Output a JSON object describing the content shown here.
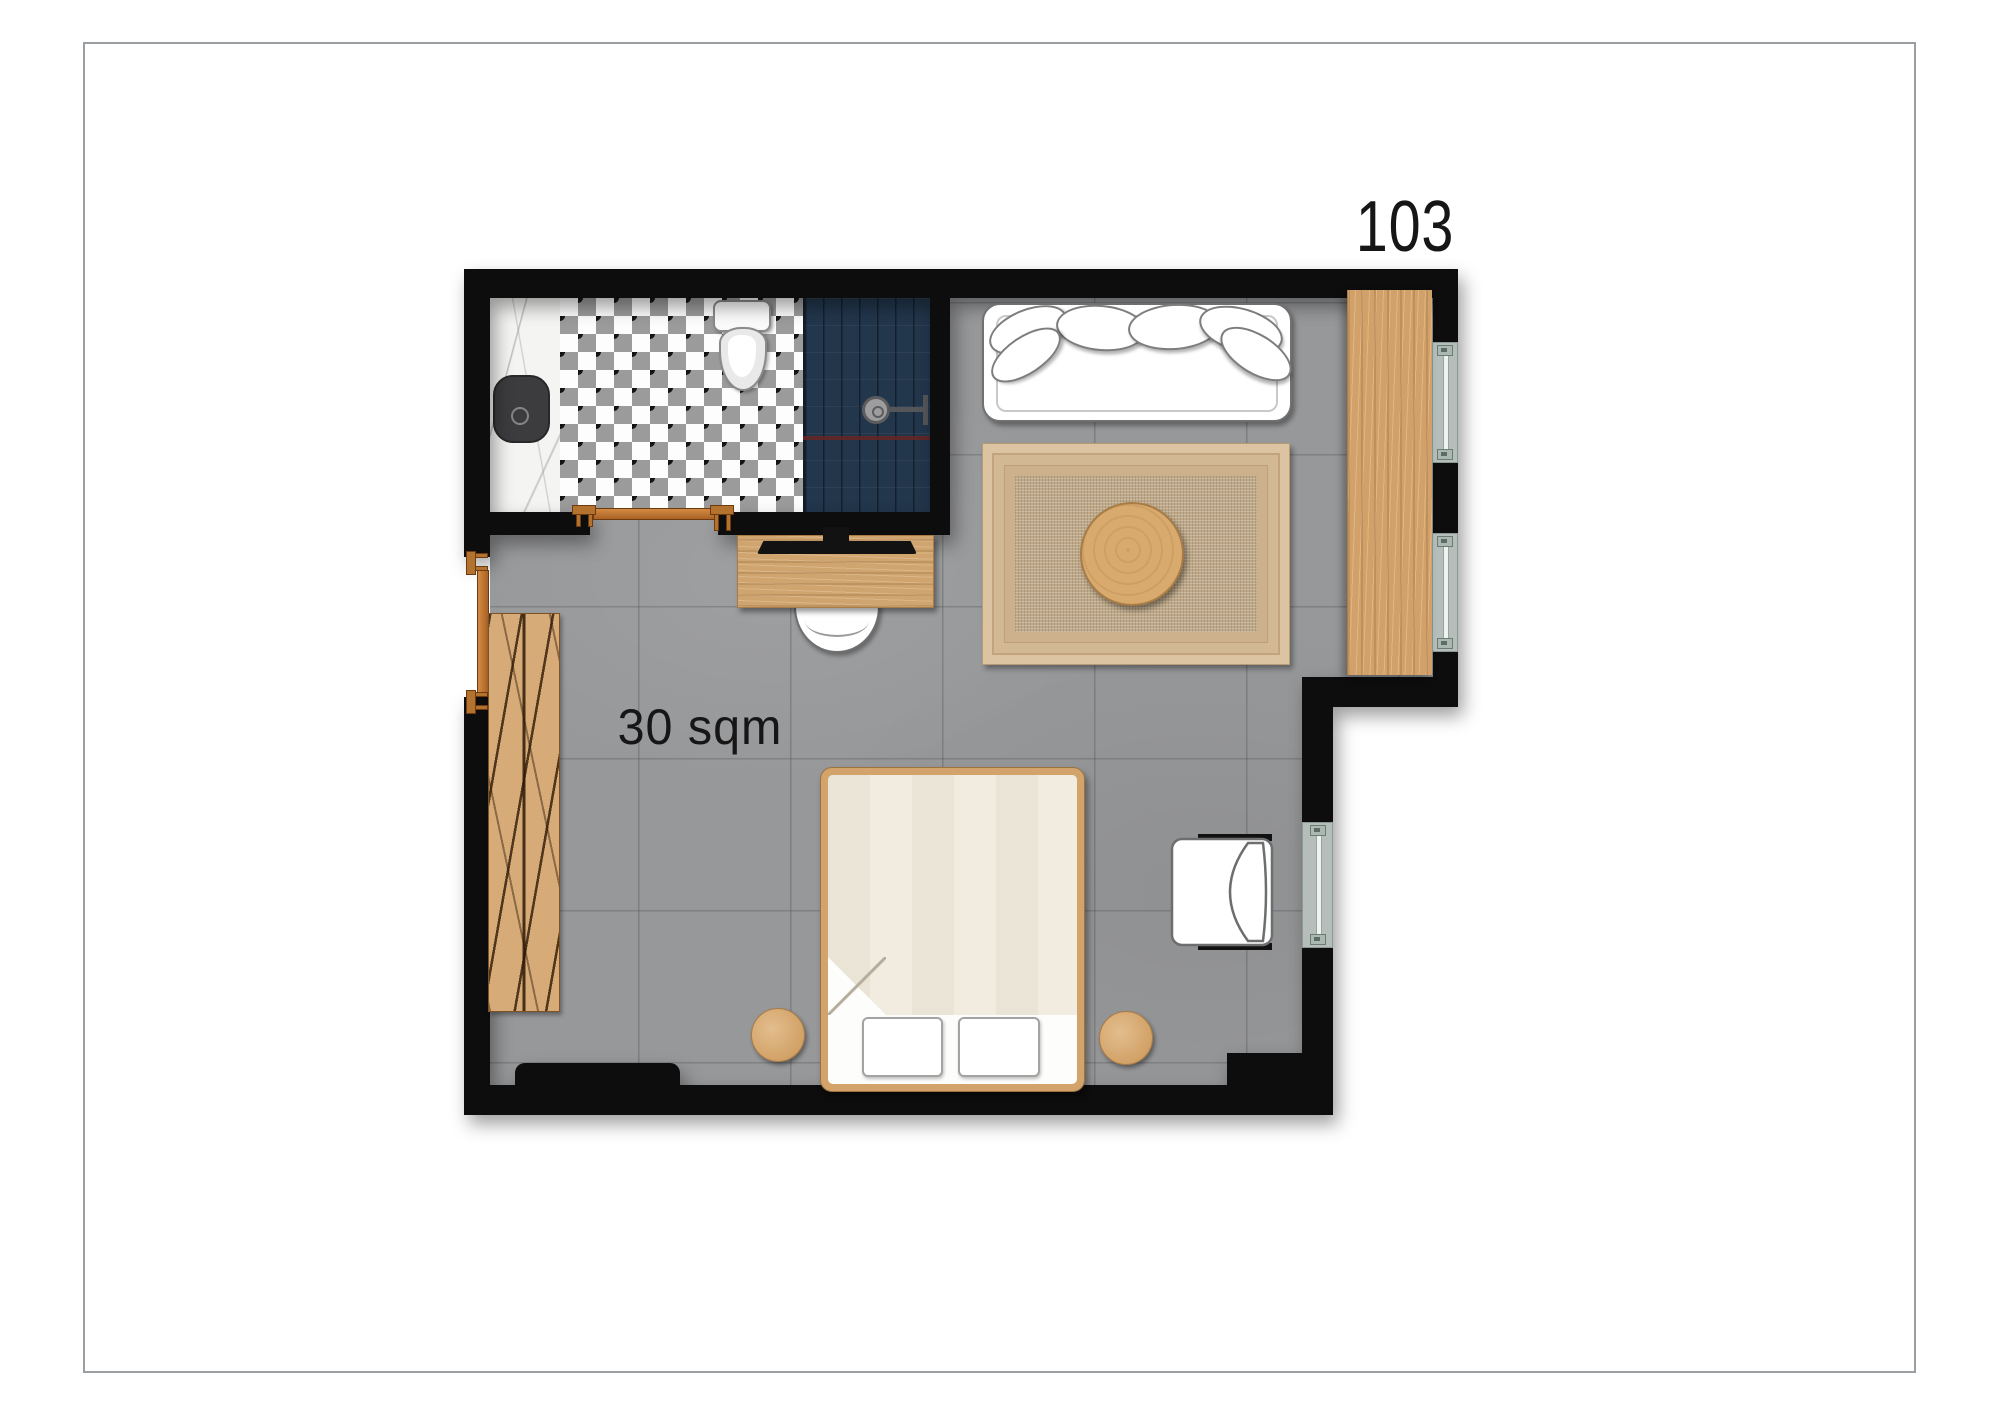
{
  "page": {
    "room_number": "103",
    "area_label": "30 sqm",
    "background": "#ffffff",
    "frame_border_color": "#9b9fa2"
  },
  "plan": {
    "type": "hotel-room-floor-plan",
    "rooms": [
      {
        "name": "bathroom",
        "position": "top-left",
        "features": [
          "marble-vanity",
          "black-sink",
          "diamond-checker-tile-floor",
          "toilet",
          "navy-shower-with-head"
        ]
      },
      {
        "name": "bedroom",
        "area": "30 sqm",
        "features": [
          "tile-floor",
          "sofa",
          "rug",
          "desk",
          "bed"
        ]
      }
    ],
    "windows": {
      "count": 3,
      "locations": [
        "upper-right-wall-top",
        "upper-right-wall-bottom",
        "lower-right-wall"
      ]
    },
    "doors": {
      "count": 2,
      "locations": [
        "entry-left-wall",
        "bathroom-bottom-wall"
      ],
      "marker_color": "#b4722f"
    },
    "furniture": [
      {
        "name": "sofa",
        "pillow_count": 6
      },
      {
        "name": "area-rug"
      },
      {
        "name": "round-coffee-table"
      },
      {
        "name": "wardrobe-panel"
      },
      {
        "name": "desk"
      },
      {
        "name": "tv"
      },
      {
        "name": "desk-chair"
      },
      {
        "name": "slatted-bench"
      },
      {
        "name": "double-bed",
        "bed_pillow_count": 2,
        "detail": "folded-duvet-corner"
      },
      {
        "name": "side-stool",
        "count": 2
      },
      {
        "name": "armchair"
      }
    ],
    "colors": {
      "wall": "#0d0d0d",
      "floor": "#97989a",
      "wood": "#d2a169",
      "shower_tile": "#22364c",
      "shower_accent_line": "#6e2420",
      "checker_gray": "#9b9b9b",
      "checker_dot": "#141414",
      "marble": "#f4f4f2",
      "sink": "#3c3c3e",
      "rug": "#dcc3a2",
      "door_marker": "#b4722f",
      "window_sill": "#b5beba",
      "label_text": "#161616"
    }
  }
}
